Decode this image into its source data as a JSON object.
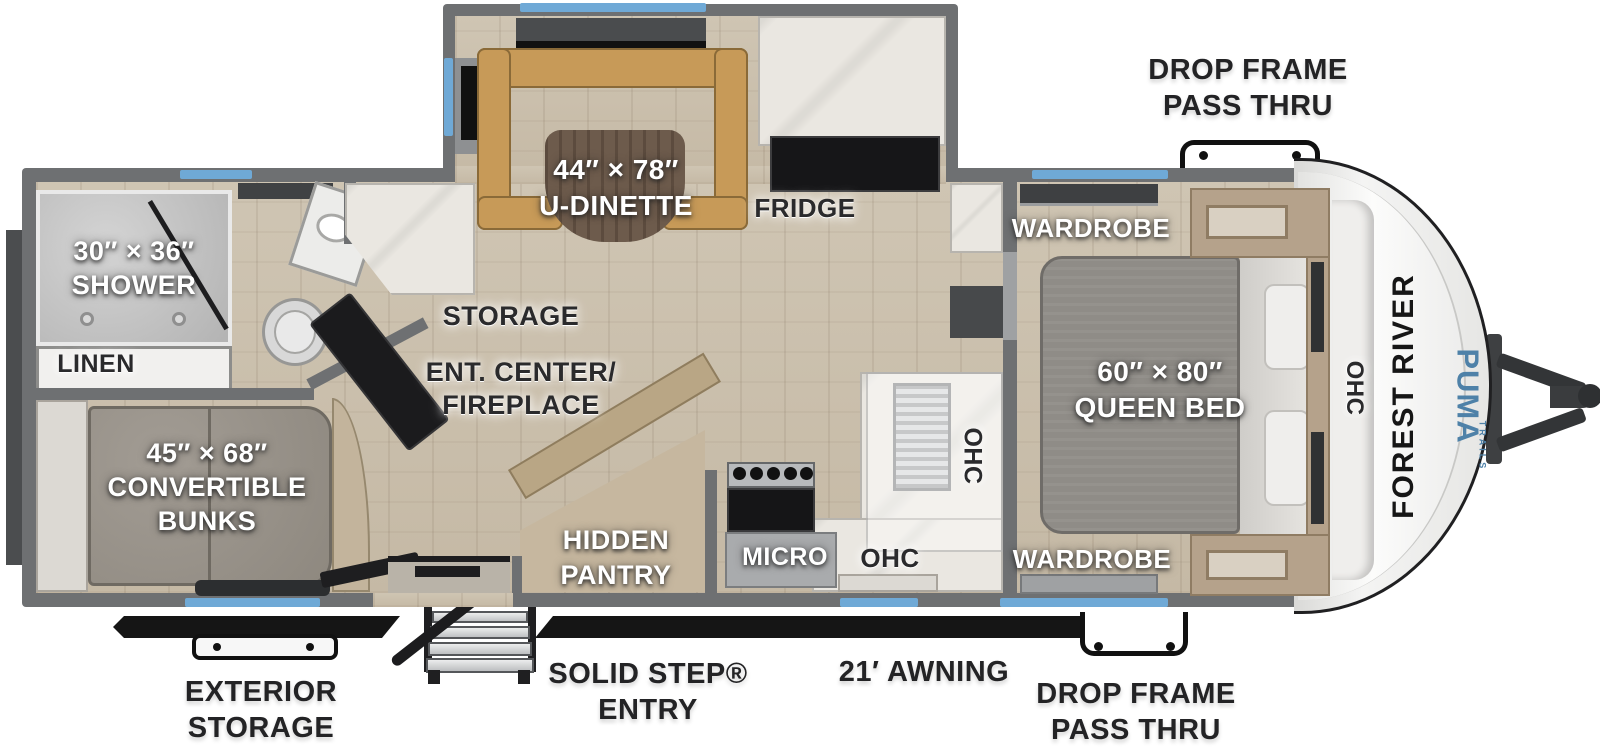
{
  "colors": {
    "wall": "#6e7072",
    "window_blue": "#6fa9d6",
    "floor_wood": "#cbc0ae",
    "dinette": "#c79a58",
    "marble": "#eae7e1",
    "black_unit": "#1b1b1d",
    "tan_cabinet": "#b5a28b",
    "mattress_gray": "#8f8c87",
    "bunk_gray": "#98928a",
    "puma_blue": "#4e81a8"
  },
  "slideout": {
    "dinette_size": "44″ × 78″",
    "dinette_label": "U-DINETTE",
    "fridge_label": "FRIDGE"
  },
  "bathroom": {
    "shower_size": "30″ × 36″",
    "shower_label": "SHOWER",
    "linen_label": "LINEN"
  },
  "bunk_room": {
    "size": "45″ × 68″",
    "label_line2": "CONVERTIBLE",
    "label_line3": "BUNKS"
  },
  "living": {
    "storage_label": "STORAGE",
    "ent_center_line1": "ENT. CENTER/",
    "ent_center_line2": "FIREPLACE",
    "pantry_line1": "HIDDEN",
    "pantry_line2": "PANTRY"
  },
  "kitchen": {
    "micro_label": "MICRO",
    "ohc_counter_label": "OHC",
    "ohc_sink_label": "OHC"
  },
  "bedroom": {
    "wardrobe_top_label": "WARDROBE",
    "bed_size": "60″ × 80″",
    "bed_label": "QUEEN BED",
    "wardrobe_bottom_label": "WARDROBE",
    "ohc_front_label": "OHC"
  },
  "exterior": {
    "drop_frame_top_line1": "DROP FRAME",
    "drop_frame_top_line2": "PASS THRU",
    "drop_frame_bottom_line1": "DROP FRAME",
    "drop_frame_bottom_line2": "PASS THRU",
    "exterior_storage_line1": "EXTERIOR",
    "exterior_storage_line2": "STORAGE",
    "entry_line1": "SOLID STEP®",
    "entry_line2": "ENTRY",
    "awning_label": "21′ AWNING"
  },
  "branding": {
    "manufacturer": "FOREST RIVER",
    "model": "PUMA",
    "series": "TRAILS"
  }
}
